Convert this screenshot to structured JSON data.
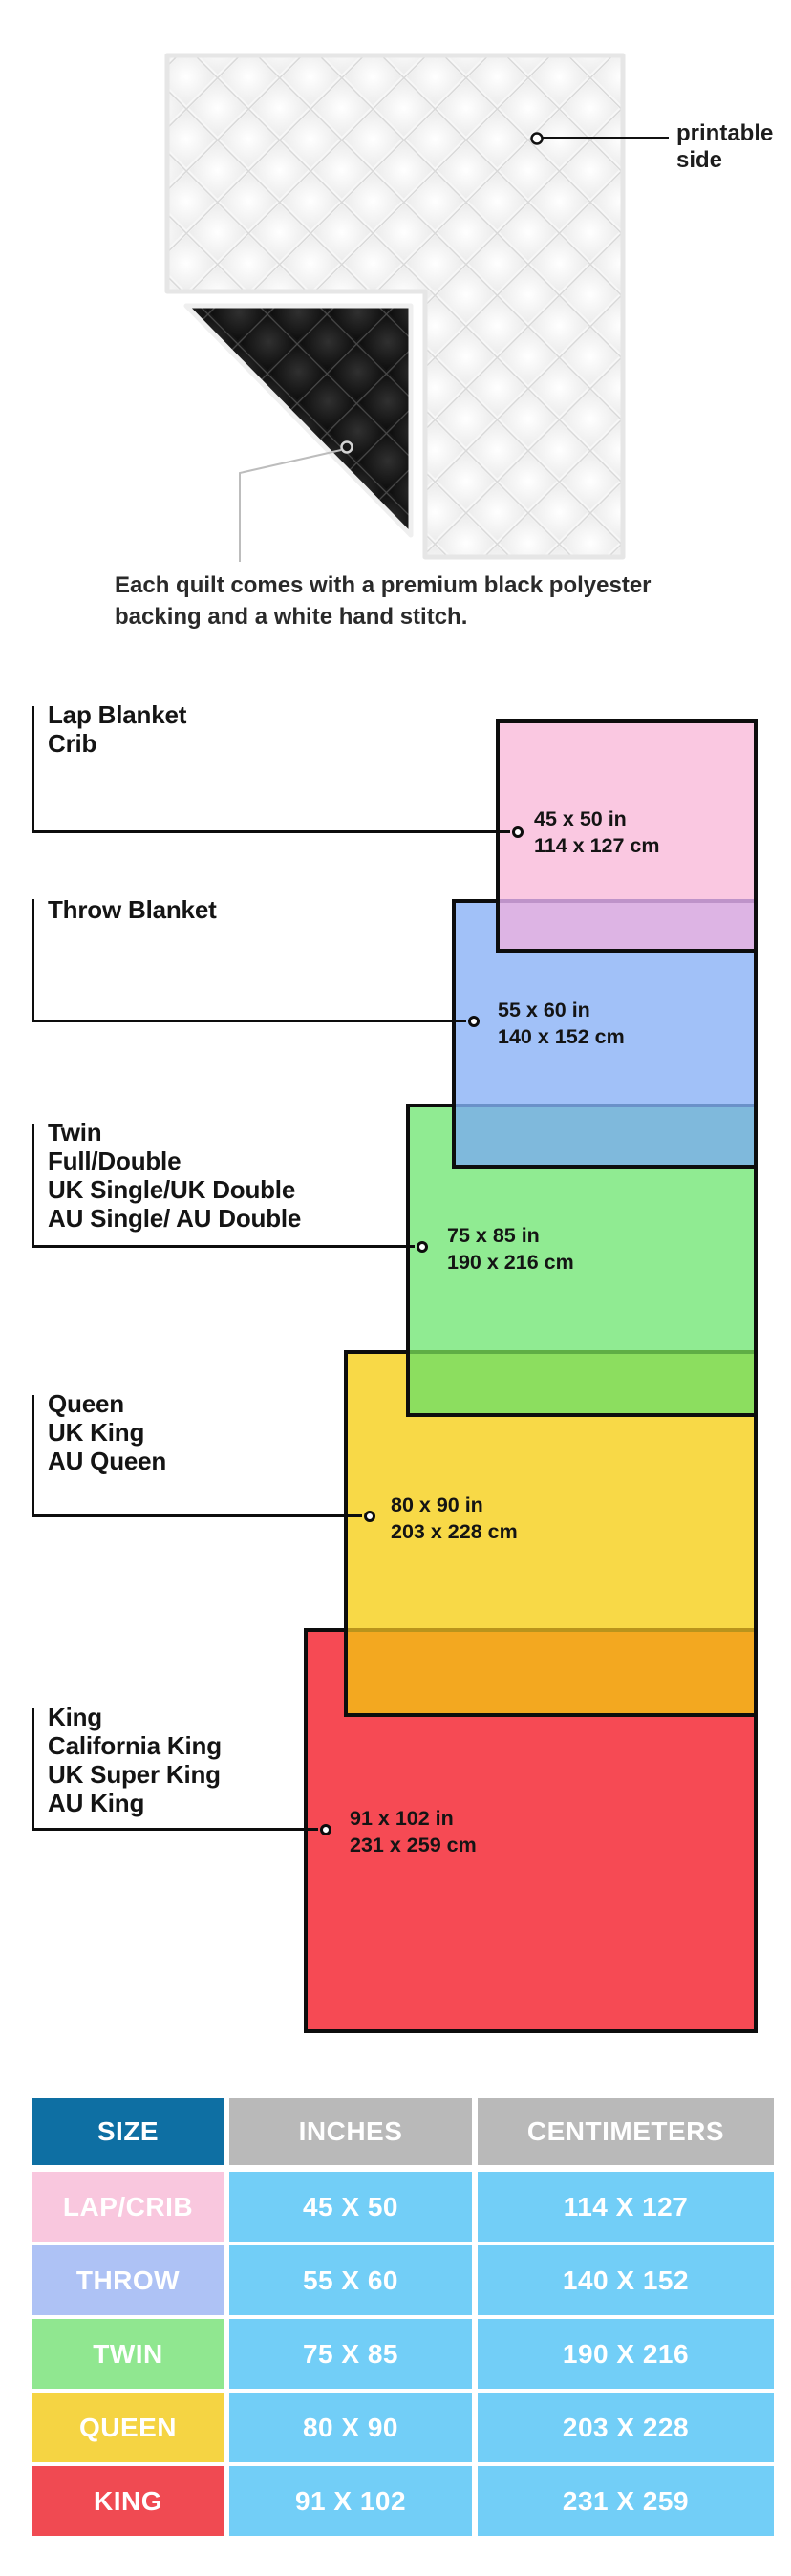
{
  "quilt": {
    "printable_note": "printable\nside",
    "caption_lines": [
      "Each quilt comes with a premium black polyester",
      "backing and a white hand stitch."
    ]
  },
  "diagram": {
    "items": [
      {
        "id": "lap",
        "label_lines": [
          "Lap Blanket",
          "Crib"
        ],
        "dim_in": "45 x 50 in",
        "dim_cm": "114 x 127 cm"
      },
      {
        "id": "throw",
        "label_lines": [
          "Throw Blanket"
        ],
        "dim_in": "55 x 60 in",
        "dim_cm": "140 x 152 cm"
      },
      {
        "id": "twin",
        "label_lines": [
          "Twin",
          "Full/Double",
          "UK Single/UK Double",
          "AU Single/ AU Double"
        ],
        "dim_in": "75 x 85 in",
        "dim_cm": "190 x 216 cm"
      },
      {
        "id": "queen",
        "label_lines": [
          "Queen",
          "UK King",
          "AU Queen"
        ],
        "dim_in": "80 x 90 in",
        "dim_cm": "203 x 228 cm"
      },
      {
        "id": "king",
        "label_lines": [
          "King",
          "California King",
          "UK Super King",
          "AU King"
        ],
        "dim_in": "91 x 102 in",
        "dim_cm": "231 x 259 cm"
      }
    ]
  },
  "table": {
    "headers": [
      "SIZE",
      "INCHES",
      "CENTIMETERS"
    ],
    "rows": [
      {
        "size": "LAP/CRIB",
        "inches": "45 X 50",
        "cm": "114 X 127"
      },
      {
        "size": "THROW",
        "inches": "55 X 60",
        "cm": "140 X 152"
      },
      {
        "size": "TWIN",
        "inches": "75 X 85",
        "cm": "190 X 216"
      },
      {
        "size": "QUEEN",
        "inches": "80 X 90",
        "cm": "203 X 228"
      },
      {
        "size": "KING",
        "inches": "91 X 102",
        "cm": "231 X 259"
      }
    ]
  },
  "colors": {
    "ink": "#0d0d0d",
    "pink": "#FAC8E1",
    "pink_overlap": "#DDB4E4",
    "pink_overlap_line": "#BE93C9",
    "blue": "#A1C1F8",
    "blue_overlap": "#7FB9DC",
    "blue_overlap_line": "#6A91C9",
    "green": "#90EB92",
    "green_overlap": "#8CDE5F",
    "green_overlap_line": "#5FAE45",
    "yellow": "#F8D947",
    "yellow_overlap": "#F3A820",
    "yellow_overlap_line": "#B9941C",
    "red": "#F64A54",
    "table_header_size_bg": "#0E6FA3",
    "table_header_bg": "#B9B9B9",
    "table_value_bg": "#72CEF7",
    "row_lap": "#F9C7DE",
    "row_throw": "#AEC2F5",
    "row_twin": "#90E790",
    "row_queen": "#F5D443",
    "row_king": "#F04A52"
  }
}
